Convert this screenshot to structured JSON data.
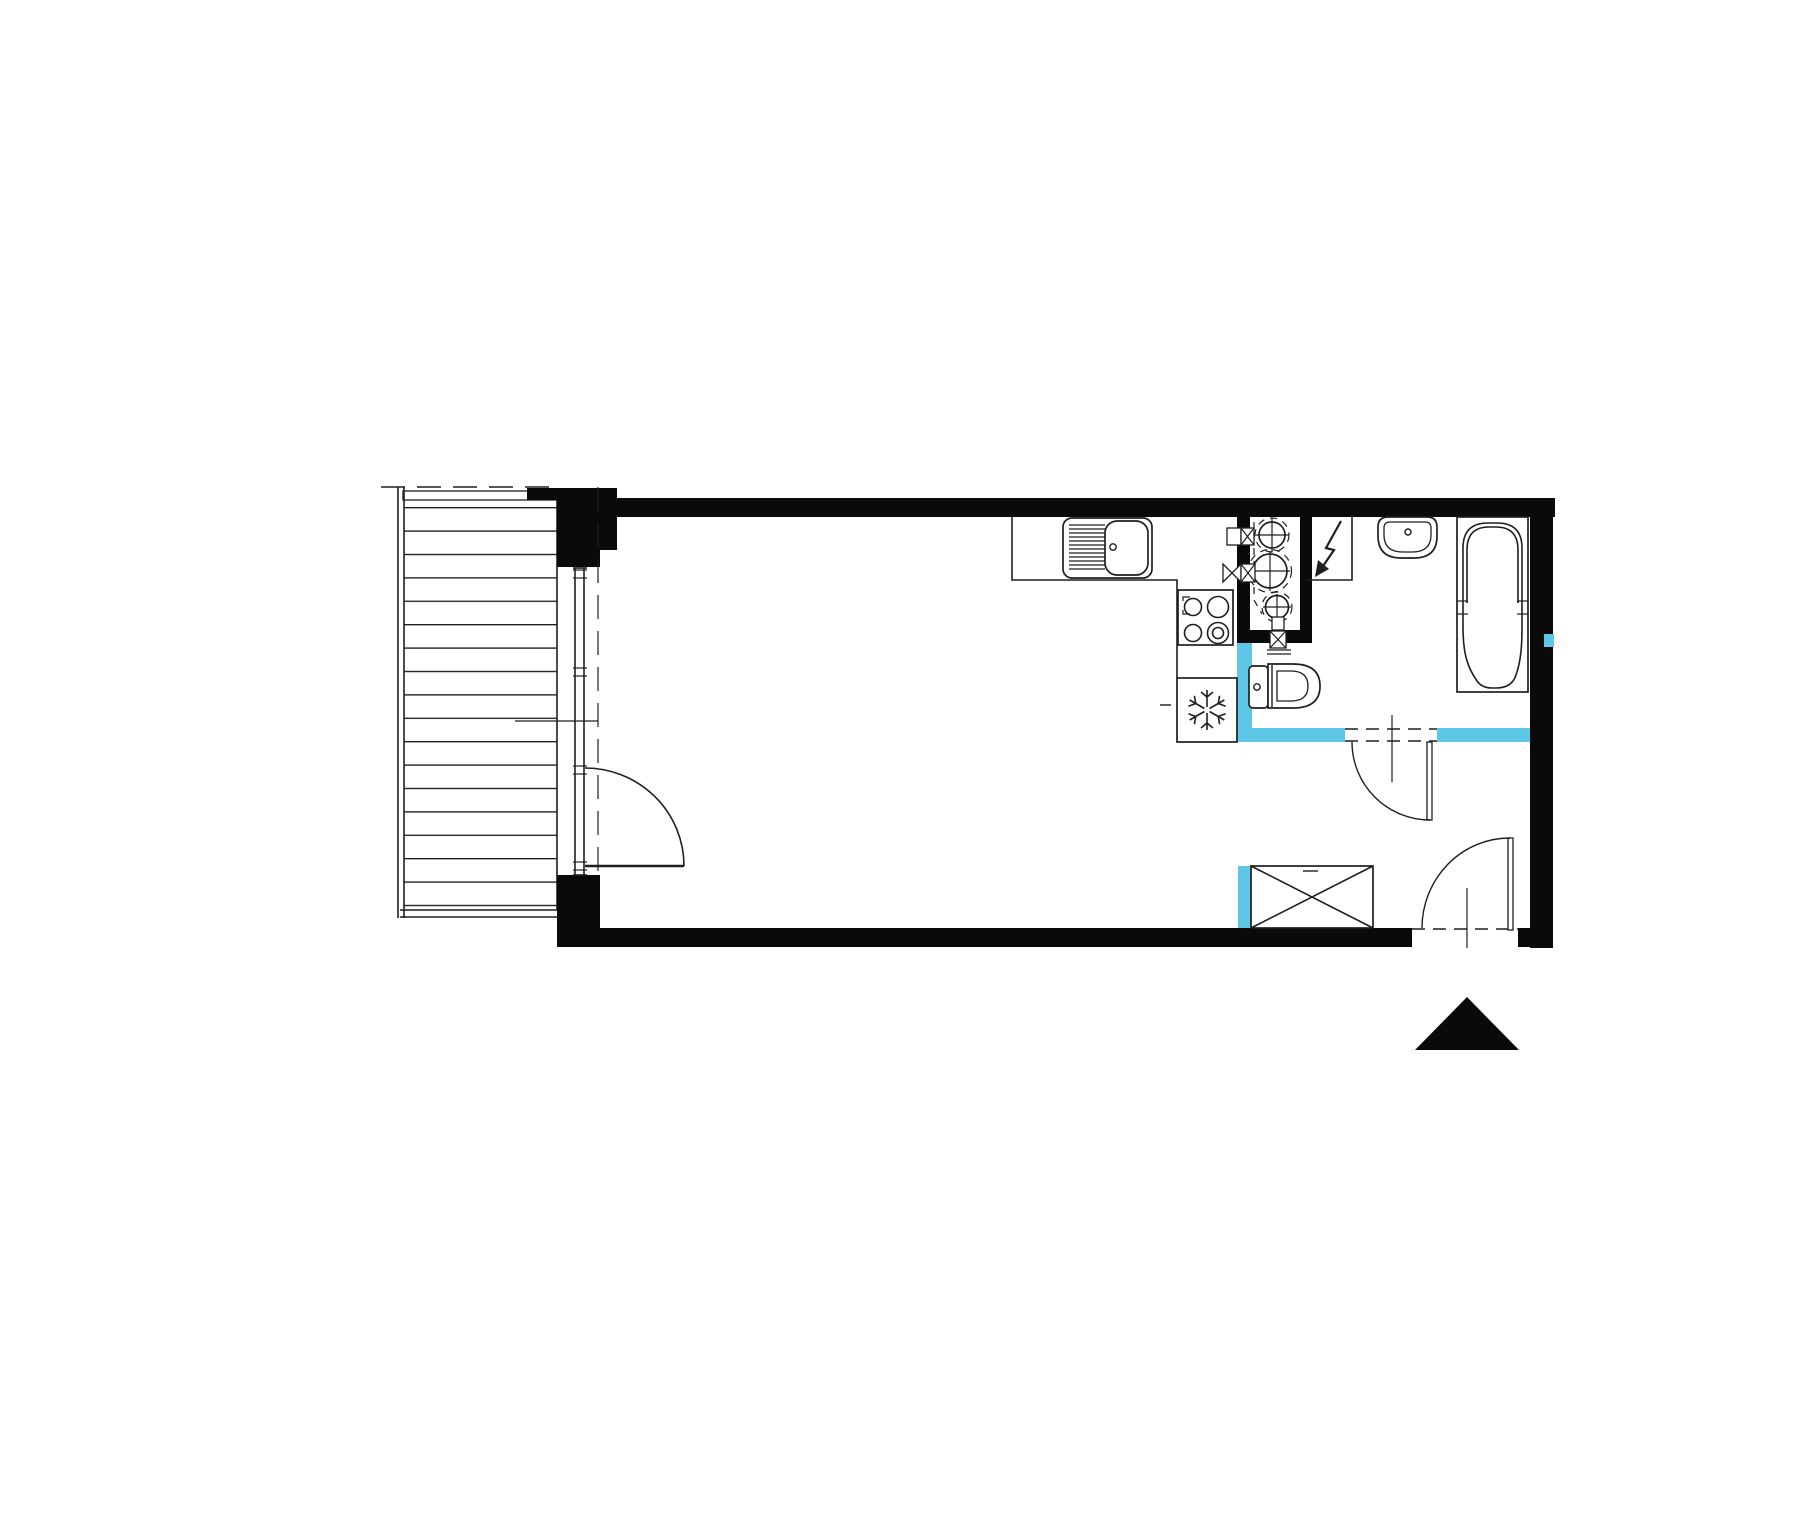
{
  "document": {
    "type": "architectural-floor-plan",
    "visible_text": ""
  },
  "colors": {
    "background": "#ffffff",
    "walls": "#0a0a0a",
    "lines": "#1f1f1f",
    "partition_accent": "#5ec7e6"
  },
  "symbols": [
    "balcony-deck",
    "balcony-door",
    "window-wall",
    "kitchen-counter",
    "kitchen-sink",
    "cooktop",
    "fridge-snowflake",
    "service-shaft",
    "water-meters",
    "shutoff-valves",
    "electrical-panel-lightning",
    "washbasin",
    "bathtub",
    "toilet",
    "bathroom-door",
    "entrance-door",
    "wardrobe",
    "north-arrow"
  ]
}
